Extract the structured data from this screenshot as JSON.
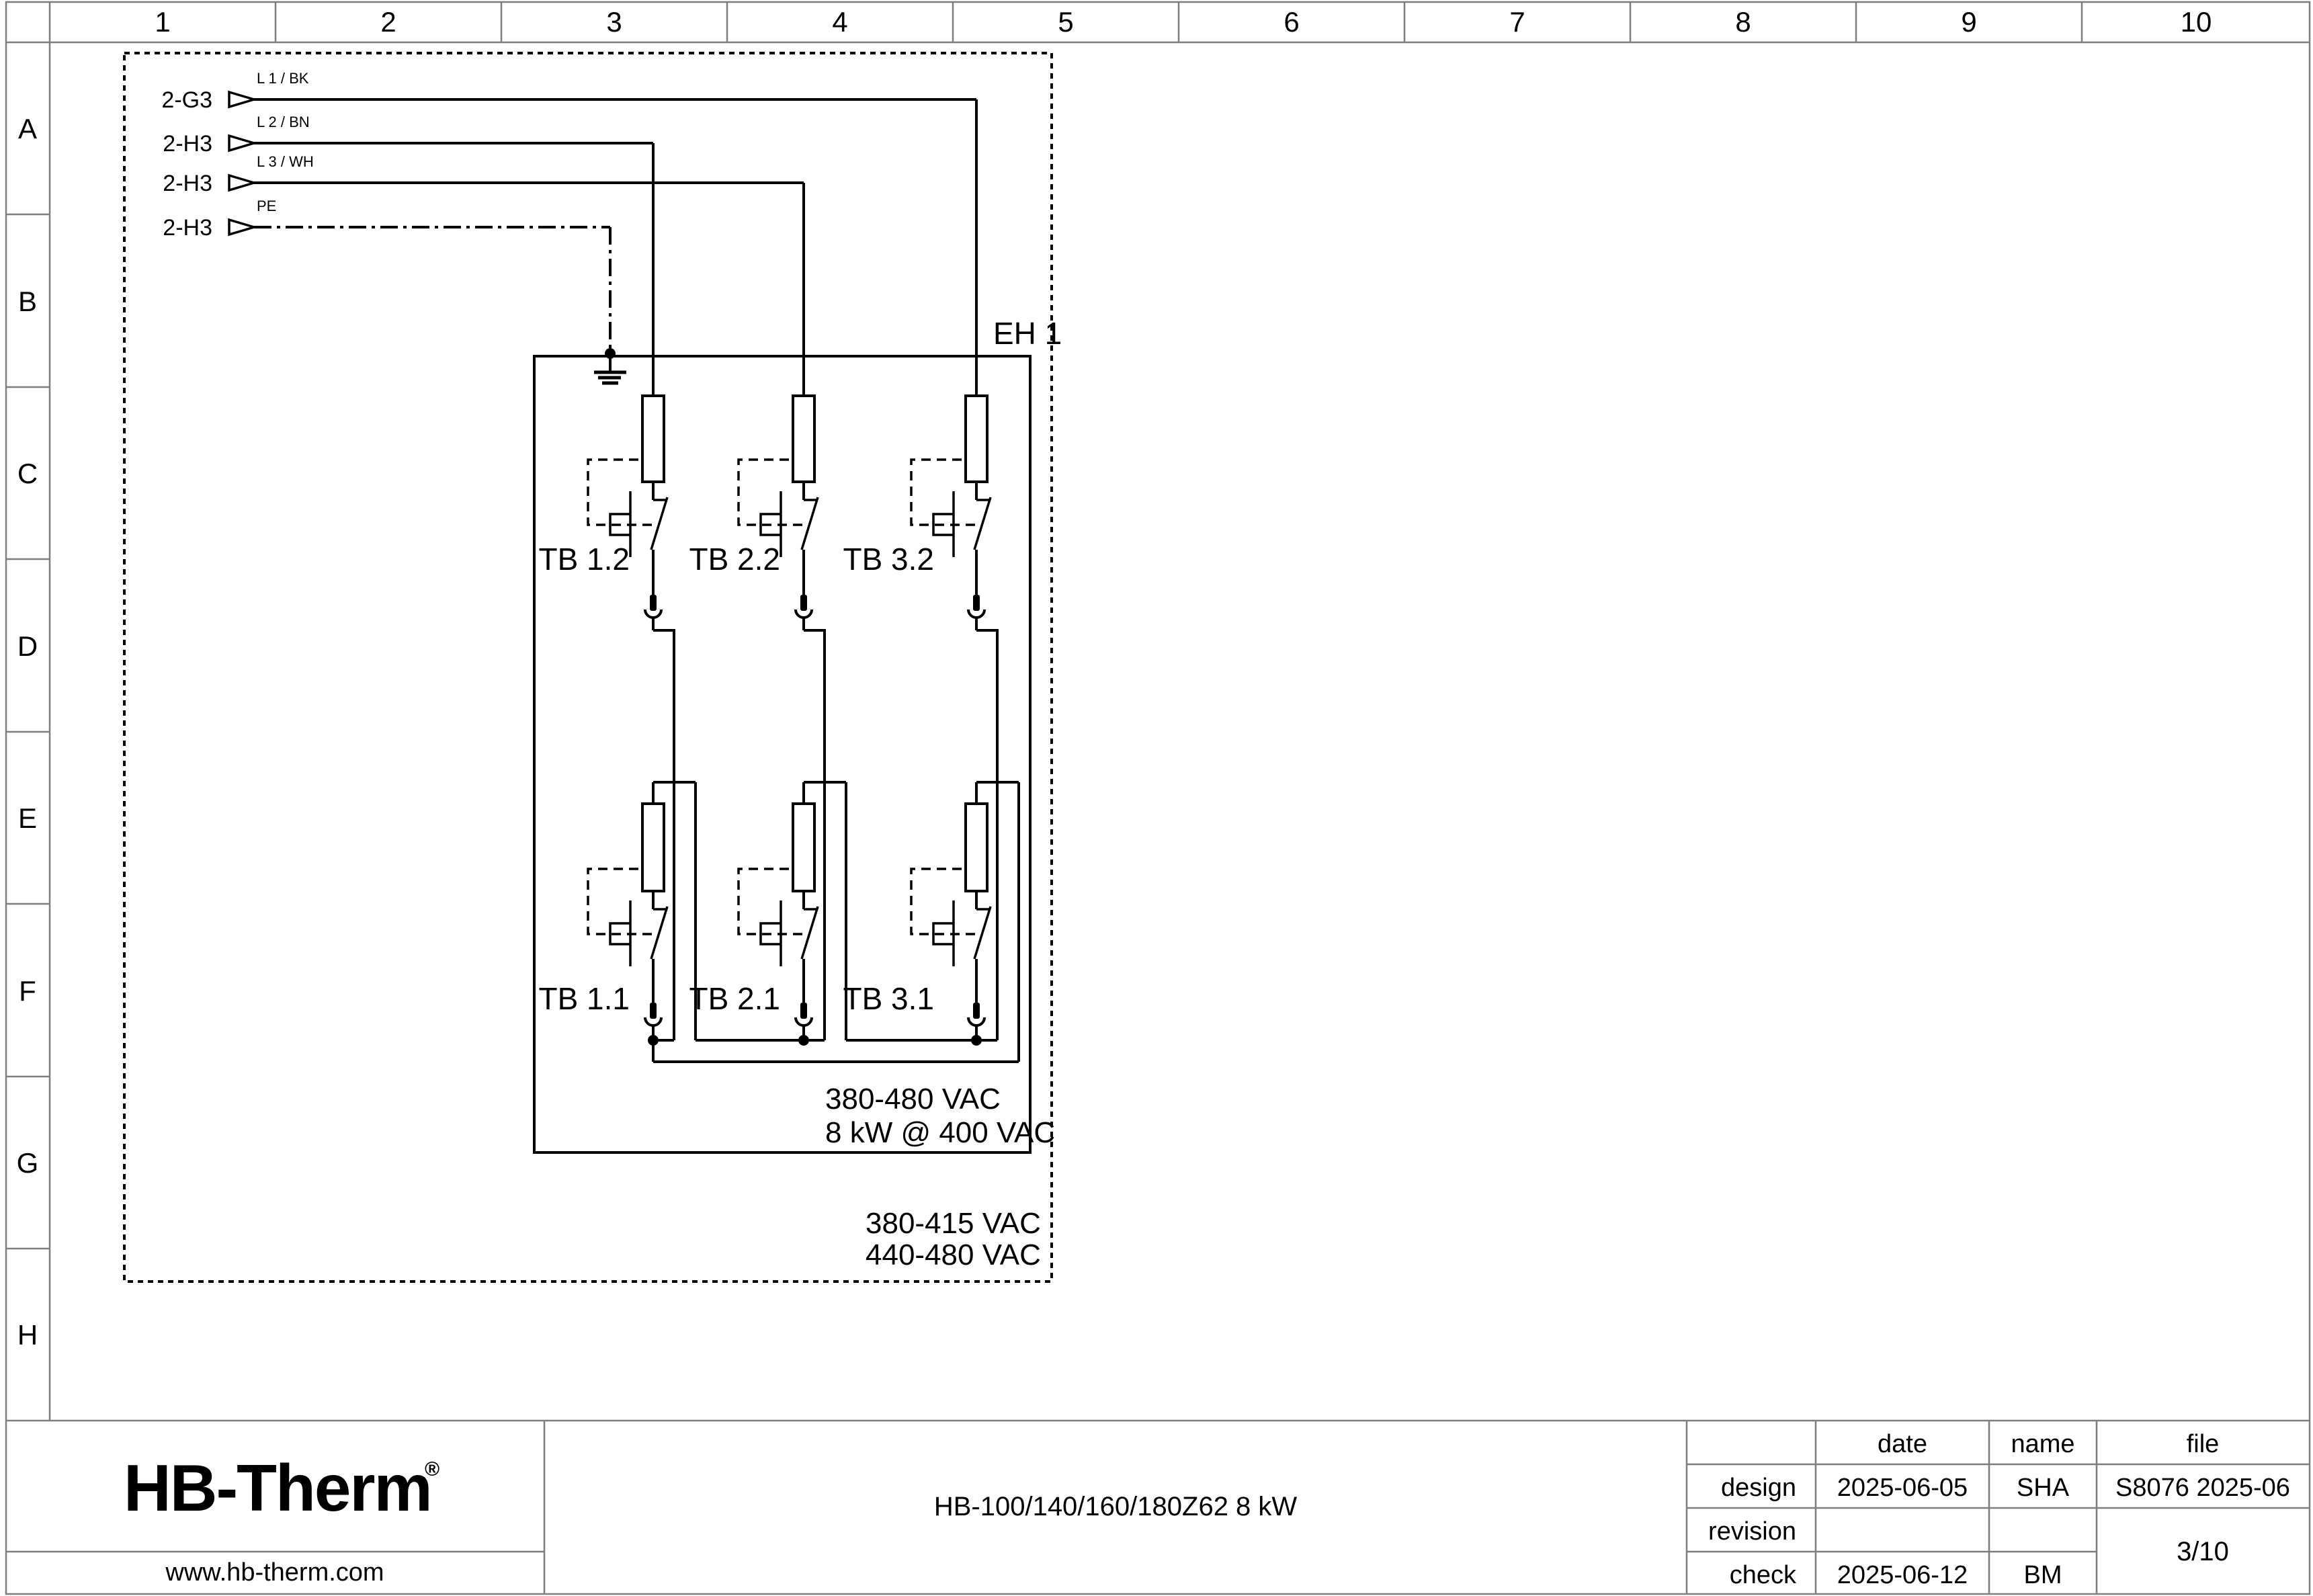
{
  "ruler": {
    "cols": [
      "1",
      "2",
      "3",
      "4",
      "5",
      "6",
      "7",
      "8",
      "9",
      "10"
    ],
    "rows": [
      "A",
      "B",
      "C",
      "D",
      "E",
      "F",
      "G",
      "H"
    ]
  },
  "schematic": {
    "inputs": [
      {
        "tag": "2-G3",
        "label": "L 1 / BK"
      },
      {
        "tag": "2-H3",
        "label": "L 2 / BN"
      },
      {
        "tag": "2-H3",
        "label": "L 3 / WH"
      },
      {
        "tag": "2-H3",
        "label": "PE"
      }
    ],
    "enclosure_label": "EH 1",
    "tb_top": [
      "TB 1.2",
      "TB 2.2",
      "TB 3.2"
    ],
    "tb_bottom": [
      "TB 1.1",
      "TB 2.1",
      "TB 3.1"
    ],
    "rating": [
      "380-480 VAC",
      "8 kW @ 400 VAC"
    ],
    "config_voltages": [
      "380-415 VAC",
      "440-480 VAC"
    ]
  },
  "titleblock": {
    "logo": "HB-Therm",
    "logo_reg": "®",
    "website": "www.hb-therm.com",
    "title": "HB-100/140/160/180Z62 8 kW",
    "headers": {
      "date": "date",
      "name": "name",
      "file": "file"
    },
    "rows": {
      "design": {
        "label": "design",
        "date": "2025-06-05",
        "name": "SHA",
        "file": "S8076 2025-06"
      },
      "revision": {
        "label": "revision"
      },
      "check": {
        "label": "check",
        "date": "2025-06-12",
        "name": "BM"
      }
    },
    "page": "3/10",
    "colors": {
      "logo_navy": "#19274e",
      "line_black": "#000000",
      "frame_gray": "#7f7f7f"
    }
  }
}
